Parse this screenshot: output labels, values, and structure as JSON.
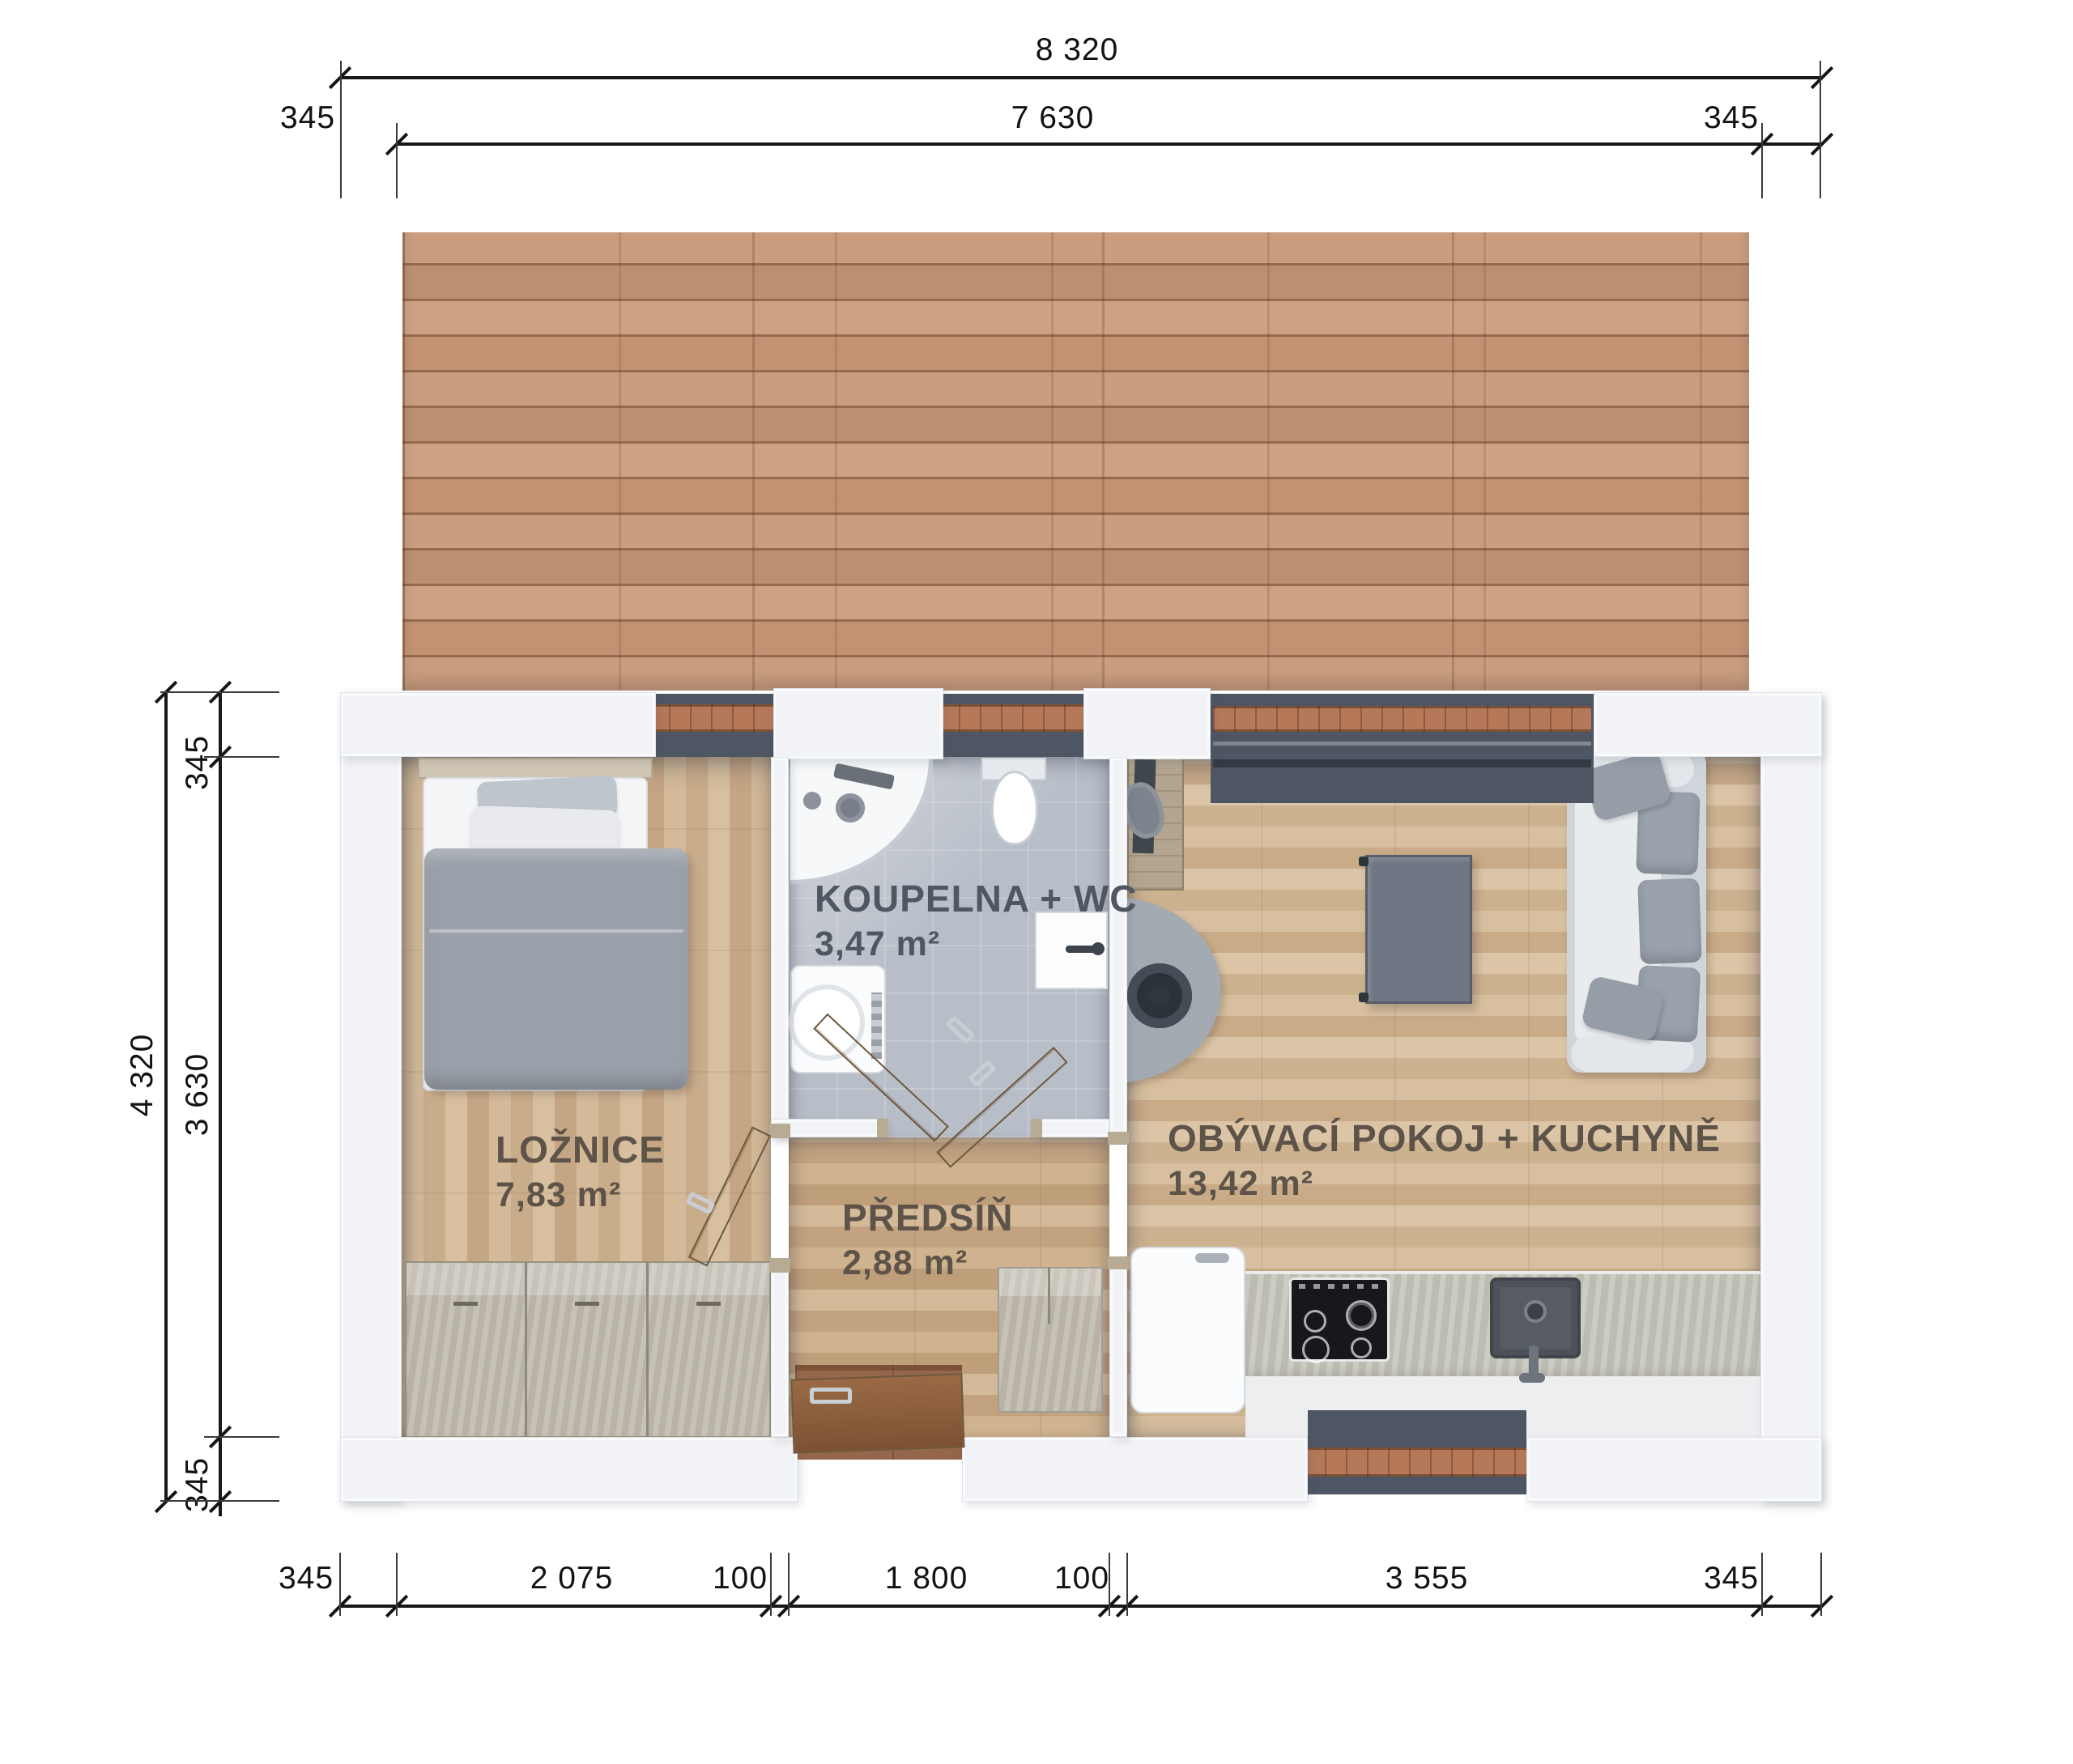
{
  "drawing": {
    "type": "floor-plan",
    "language": "cs"
  },
  "dimensions": {
    "top": {
      "overall": "8 320",
      "inner": "7 630",
      "left_offset": "345",
      "right_offset": "345"
    },
    "left": {
      "overall": "4 320",
      "top_offset": "345",
      "inner": "3 630",
      "bottom_offset": "345"
    },
    "bottom": {
      "left_offset": "345",
      "bedroom_width": "2 075",
      "wall_a": "100",
      "hall_width": "1 800",
      "wall_b": "100",
      "living_width": "3 555",
      "right_offset": "345"
    }
  },
  "rooms": {
    "bedroom": {
      "name": "LOŽNICE",
      "area": "7,83 m²"
    },
    "bathroom": {
      "name": "KOUPELNA + WC",
      "area": "3,47 m²"
    },
    "hall": {
      "name": "PŘEDSÍŇ",
      "area": "2,88 m²"
    },
    "living": {
      "name": "OBÝVACÍ POKOJ + KUCHYNĚ",
      "area": "13,42 m²"
    }
  },
  "colors": {
    "wall": "#f2f3f6",
    "wall_edge": "#dfe2e8",
    "deck_wood": "#c59878",
    "sill_wood": "#b5795a",
    "recess_dark": "#4f5663",
    "tile": "#b8bec8",
    "floor_dark_entry": "#8a5c40",
    "cabinet_concrete": "#c0bbae",
    "counter": "#c7c6bc",
    "cooktop_black": "#17181c",
    "sofa_body": "#cfd5db",
    "cushion_gray": "#99a1ab",
    "table_gray": "#6e7783",
    "label_brown": "#5d5348",
    "label_gray": "#515761",
    "dim_text": "#121212"
  }
}
